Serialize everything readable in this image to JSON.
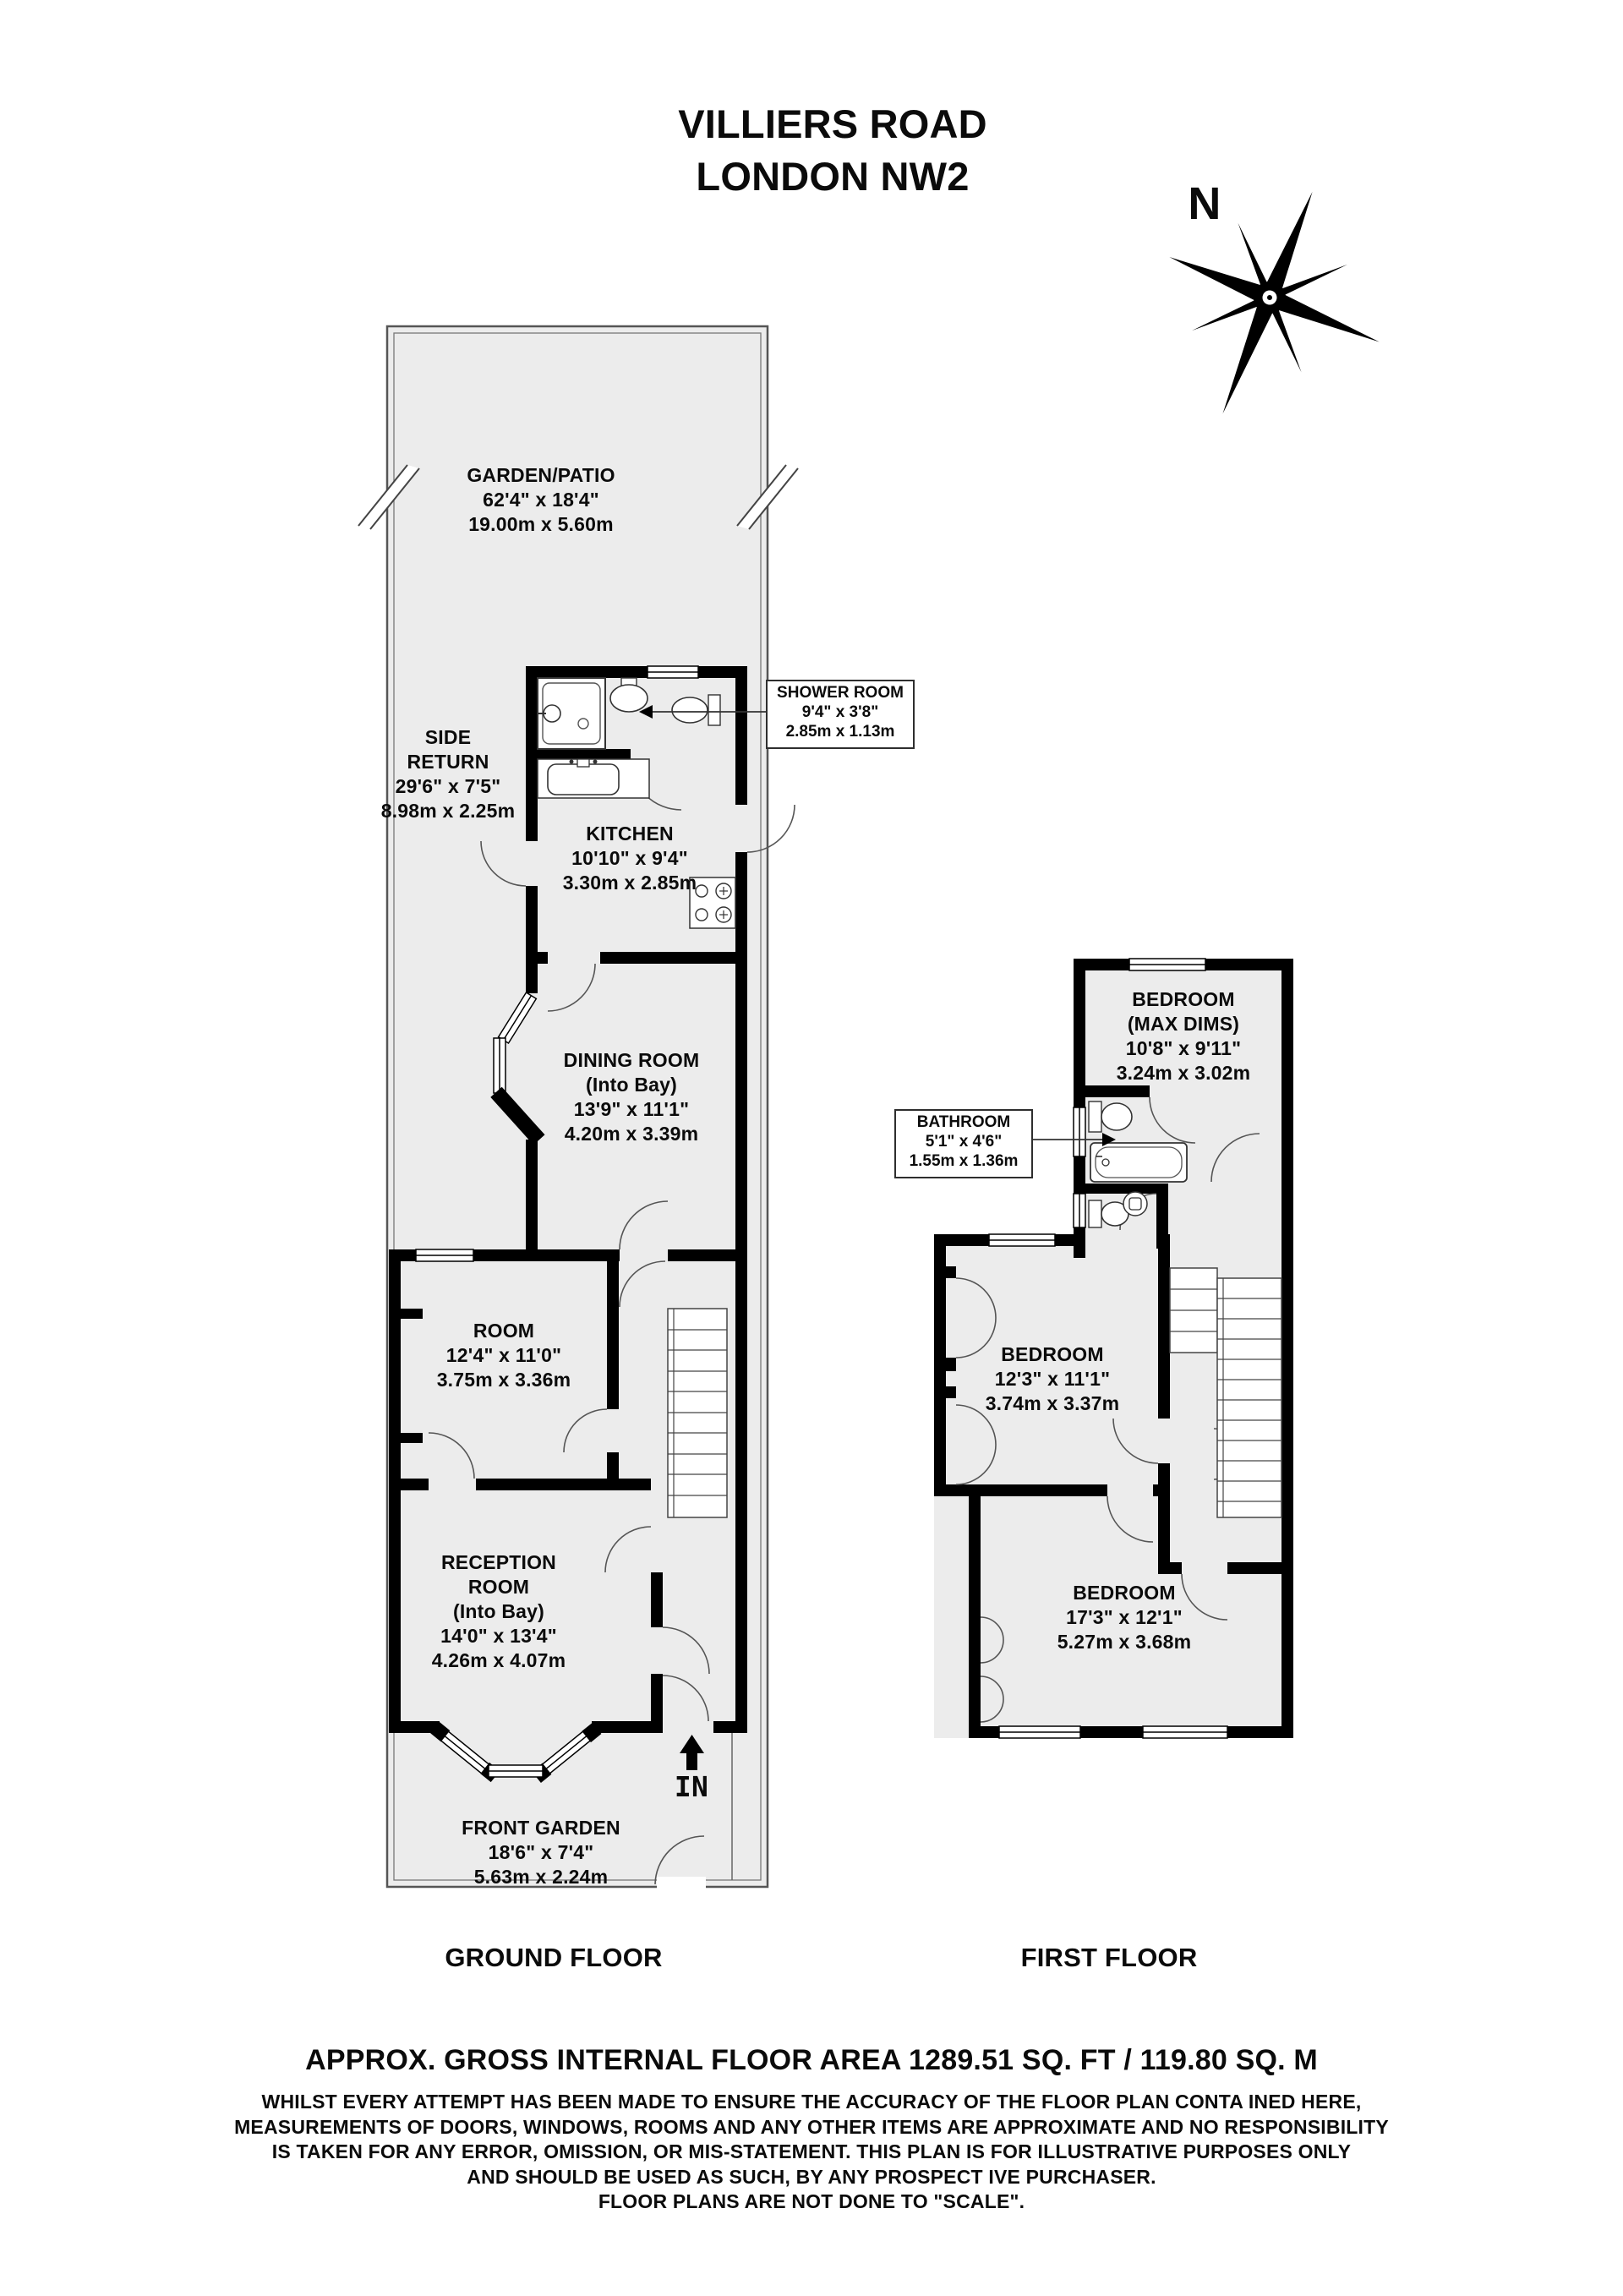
{
  "title": {
    "line1": "VILLIERS ROAD",
    "line2": "LONDON NW2"
  },
  "compass": {
    "label": "N"
  },
  "ground_floor": {
    "label": "GROUND FLOOR",
    "garden": {
      "name": "GARDEN/PATIO",
      "imperial": "62'4\" x 18'4\"",
      "metric": "19.00m x 5.60m"
    },
    "side_return": {
      "name1": "SIDE",
      "name2": "RETURN",
      "imperial": "29'6\" x 7'5\"",
      "metric": "8.98m x 2.25m"
    },
    "shower_room": {
      "name": "SHOWER ROOM",
      "imperial": "9'4\" x 3'8\"",
      "metric": "2.85m x 1.13m"
    },
    "kitchen": {
      "name": "KITCHEN",
      "imperial": "10'10\" x 9'4\"",
      "metric": "3.30m x 2.85m"
    },
    "dining_room": {
      "name": "DINING ROOM",
      "qualifier": "(Into Bay)",
      "imperial": "13'9\" x 11'1\"",
      "metric": "4.20m x 3.39m"
    },
    "room": {
      "name": "ROOM",
      "imperial": "12'4\" x 11'0\"",
      "metric": "3.75m x 3.36m"
    },
    "reception_room": {
      "name1": "RECEPTION",
      "name2": "ROOM",
      "qualifier": "(Into Bay)",
      "imperial": "14'0\" x 13'4\"",
      "metric": "4.26m x 4.07m"
    },
    "front_garden": {
      "name": "FRONT GARDEN",
      "imperial": "18'6\" x 7'4\"",
      "metric": "5.63m x 2.24m"
    },
    "entrance": {
      "label": "IN"
    }
  },
  "first_floor": {
    "label": "FIRST FLOOR",
    "bedroom_rear": {
      "name": "BEDROOM",
      "qualifier": "(MAX DIMS)",
      "imperial": "10'8\" x 9'11\"",
      "metric": "3.24m x 3.02m"
    },
    "bathroom": {
      "name": "BATHROOM",
      "imperial": "5'1\" x 4'6\"",
      "metric": "1.55m x 1.36m"
    },
    "bedroom_middle": {
      "name": "BEDROOM",
      "imperial": "12'3\" x 11'1\"",
      "metric": "3.74m x 3.37m"
    },
    "bedroom_front": {
      "name": "BEDROOM",
      "imperial": "17'3\" x 12'1\"",
      "metric": "5.27m x 3.68m"
    }
  },
  "footer": {
    "area_summary": "APPROX. GROSS INTERNAL FLOOR AREA 1289.51 SQ. FT / 119.80 SQ. M",
    "disclaimer_line1": "WHILST EVERY ATTEMPT HAS BEEN MADE TO ENSURE THE ACCURACY OF THE FLOOR PLAN CONTA INED HERE,",
    "disclaimer_line2": "MEASUREMENTS OF DOORS, WINDOWS, ROOMS AND ANY OTHER ITEMS ARE APPROXIMATE AND NO RESPONSIBILITY",
    "disclaimer_line3": "IS TAKEN FOR ANY ERROR, OMISSION, OR MIS-STATEMENT. THIS PLAN IS FOR ILLUSTRATIVE PURPOSES ONLY",
    "disclaimer_line4": "AND SHOULD BE USED AS SUCH, BY ANY PROSPECT IVE PURCHASER.",
    "disclaimer_line5": "FLOOR PLANS ARE NOT DONE TO \"SCALE\"."
  },
  "colors": {
    "wall": "#000000",
    "floor": "#ececec",
    "outline": "#4a4a4a"
  }
}
